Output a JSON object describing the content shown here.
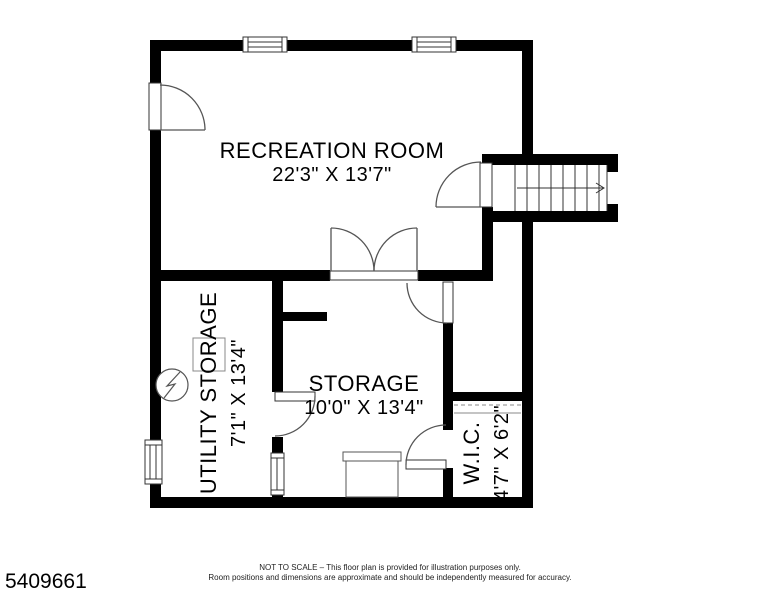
{
  "document_type": "floor-plan",
  "rooms": {
    "recreation": {
      "name": "RECREATION ROOM",
      "dims": "22'3\" X 13'7\""
    },
    "utility": {
      "name": "UTILITY STORAGE",
      "dims": "7'1\" X 13'4\""
    },
    "storage": {
      "name": "STORAGE",
      "dims": "10'0\" X 13'4\""
    },
    "wic": {
      "name": "W.I.C.",
      "dims": "4'7\" X 6'2\""
    }
  },
  "footer": {
    "plan_number": "5409661",
    "disclaimer_line1": "NOT TO SCALE – This floor plan is provided for illustration purposes only.",
    "disclaimer_line2": "Room positions and dimensions are approximate and should be independently measured for accuracy."
  },
  "symbols": {
    "stair_direction": "arrow-right",
    "electrical_panel": "circle-lightning-bolt",
    "closet_feature": "dashed-rod-and-shelf",
    "window_count": 4,
    "door_count": 7
  },
  "colors": {
    "wall": "#000000",
    "background": "#ffffff",
    "thin_line": "#555555"
  }
}
